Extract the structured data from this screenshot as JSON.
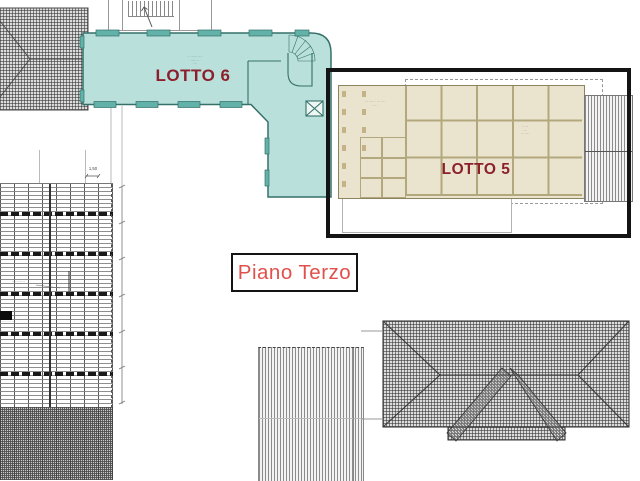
{
  "drawing": {
    "floor_label": "Piano Terzo",
    "lots": {
      "lotto6": {
        "label": "LOTTO 6",
        "note_lines": [
          "·· ······ ····",
          "····· ··",
          "···"
        ]
      },
      "lotto5": {
        "label": "LOTTO 5",
        "note_lines": [
          "·· ···",
          "···",
          "··· ····"
        ],
        "left_block_note_lines": [
          "··· ······ ··· ····",
          "··· ·"
        ]
      }
    },
    "annotations": {
      "dim_150": "1,50",
      "framing_leader_note": "···· ···· ··",
      "black_patch_caption": "····· ···· ··"
    }
  },
  "colors": {
    "teal_fill": "#b9e0da",
    "teal_stroke": "#35706a",
    "teal_pier": "#63b2a9",
    "beige_fill": "#eae3cd",
    "beige_line": "#b3a87d",
    "beige_border": "#8d835f",
    "lot_label": "#8c1f2d",
    "floor_label": "#e1504b",
    "frame": "#141414"
  }
}
